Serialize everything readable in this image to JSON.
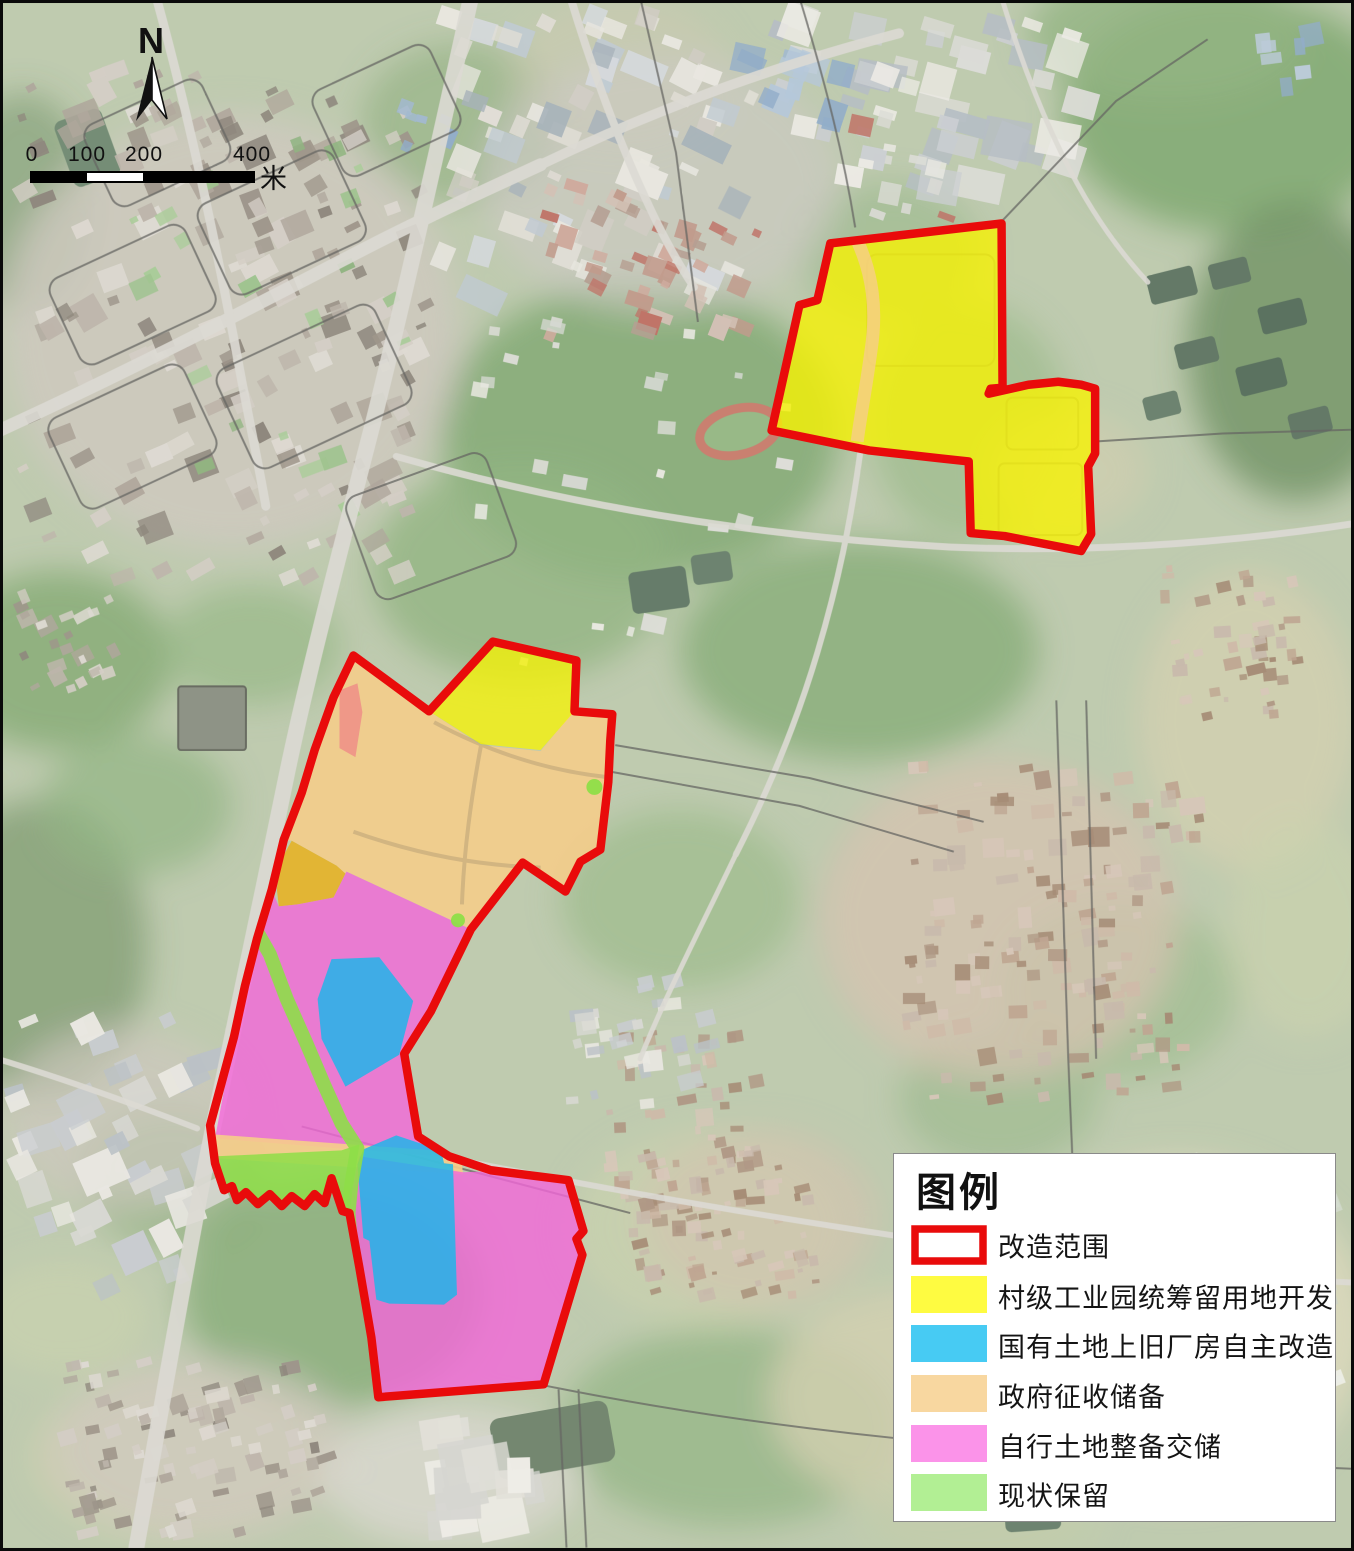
{
  "compass": {
    "label": "N"
  },
  "scale_bar": {
    "ticks": [
      "0",
      "100",
      "200",
      "400"
    ],
    "unit": "米"
  },
  "legend": {
    "title": "图例",
    "items": [
      {
        "name": "renovation-extent",
        "label": "改造范围",
        "color": "#e90b0b",
        "swatch": "outline"
      },
      {
        "name": "village-industrial-park-development",
        "label": "村级工业园统筹留用地开发",
        "color": "#fefb41",
        "swatch": "fill"
      },
      {
        "name": "state-owned-old-factory-self-renewal",
        "label": "国有土地上旧厂房自主改造",
        "color": "#47cbf3",
        "swatch": "fill"
      },
      {
        "name": "government-expropriation-reserve",
        "label": "政府征收储备",
        "color": "#f8d7a0",
        "swatch": "fill"
      },
      {
        "name": "self-land-consolidation-transfer",
        "label": "自行土地整备交储",
        "color": "#fb93e9",
        "swatch": "fill"
      },
      {
        "name": "status-quo-retained",
        "label": "现状保留",
        "color": "#b2ef94",
        "swatch": "fill"
      }
    ]
  },
  "overlay": {
    "boundary_color": "#e90b0b",
    "colors": {
      "yellow": "#f8f400",
      "cyan": "#18b7ea",
      "orange": "#f6cd8a",
      "pink": "#f467da",
      "green": "#8ede48",
      "mustard": "#e6b327",
      "salmon": "#ee8e86"
    }
  }
}
